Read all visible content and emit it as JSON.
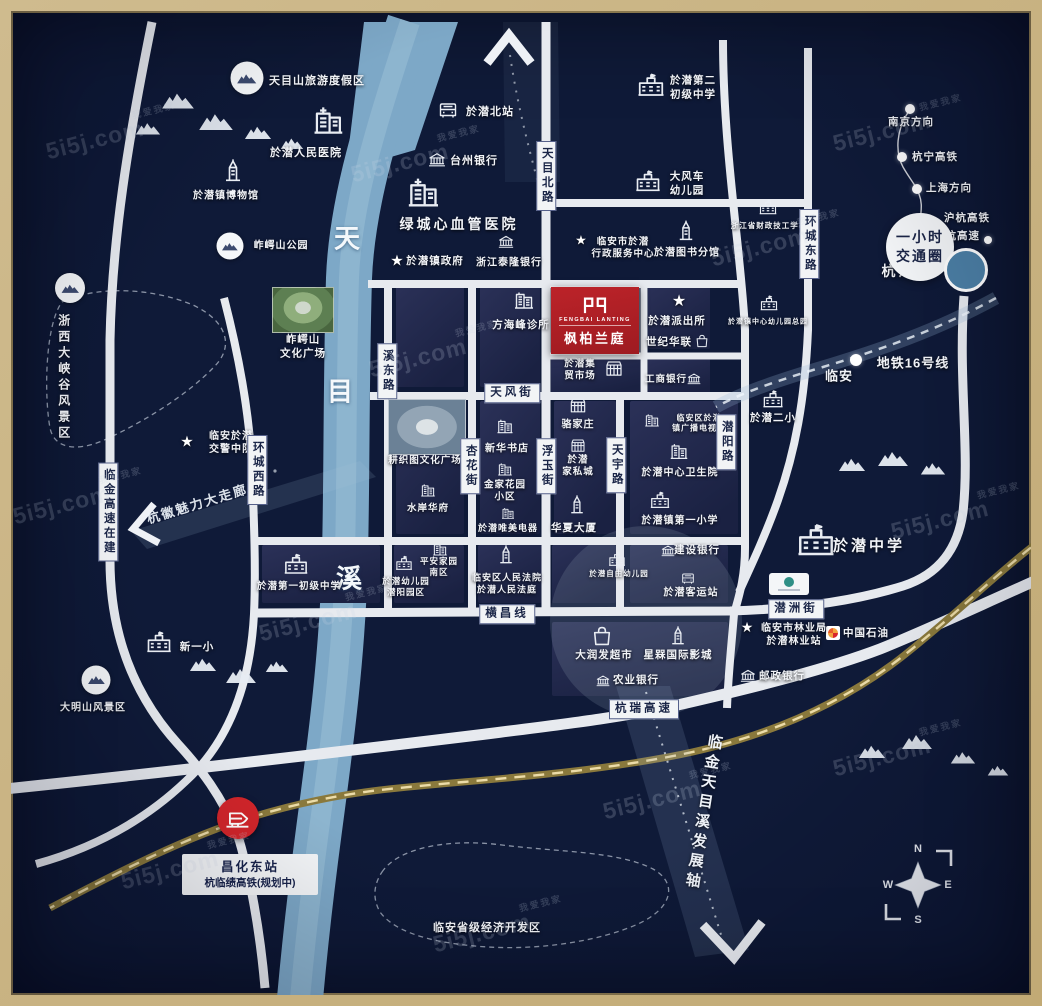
{
  "glyphs": {
    "star": "★"
  },
  "colors": {
    "bg": "#0f1a38",
    "river": "#7da8c7",
    "road": "#e7eaef",
    "gold_frame": "#c2aa75",
    "project_red": "#b02025",
    "railway": "#8a793c",
    "hangzhou_blue": "#4c80a6"
  },
  "project": {
    "name_en": "FENGBAI LANTING",
    "name_cn": "枫柏兰庭"
  },
  "transit": {
    "one_hour_l1": "一小时",
    "one_hour_l2": "交通圈"
  },
  "station": {
    "name": "昌化东站",
    "note": "杭临绩高铁(规划中)"
  },
  "areas": {
    "corridor": "杭徽魅力大走廊",
    "axis": "临金天目溪发展轴",
    "econ_zone": "临安省级经济开发区"
  },
  "compass": {
    "n": "N",
    "e": "E",
    "s": "S",
    "w": "W"
  },
  "watermark": {
    "text": "5i5j.com",
    "tag": "我爱我家",
    "positions": [
      [
        95,
        140
      ],
      [
        400,
        163
      ],
      [
        882,
        132
      ],
      [
        418,
        358
      ],
      [
        62,
        505
      ],
      [
        308,
        622
      ],
      [
        652,
        800
      ],
      [
        882,
        757
      ],
      [
        482,
        933
      ],
      [
        760,
        247
      ],
      [
        170,
        870
      ],
      [
        940,
        520
      ]
    ]
  },
  "river": {
    "chars": [
      {
        "c": "天",
        "x": 347,
        "y": 237
      },
      {
        "c": "目",
        "x": 340,
        "y": 390
      },
      {
        "c": "溪",
        "x": 349,
        "y": 577
      }
    ]
  },
  "road_labels": [
    {
      "text": "天目北路",
      "x": 546,
      "y": 176,
      "vert": true
    },
    {
      "text": "溪东路",
      "x": 387,
      "y": 371,
      "vert": true
    },
    {
      "text": "杏花街",
      "x": 470,
      "y": 466,
      "vert": true
    },
    {
      "text": "浮玉街",
      "x": 546,
      "y": 466,
      "vert": true
    },
    {
      "text": "天宇路",
      "x": 616,
      "y": 465,
      "vert": true
    },
    {
      "text": "潜阳路",
      "x": 726,
      "y": 442,
      "vert": true
    },
    {
      "text": "环城东路",
      "x": 809,
      "y": 244,
      "vert": true
    },
    {
      "text": "环城西路",
      "x": 257,
      "y": 470,
      "vert": true
    },
    {
      "text": "临金高速在建",
      "x": 108,
      "y": 512,
      "vert": true
    },
    {
      "text": "天风街",
      "x": 512,
      "y": 393,
      "vert": false
    },
    {
      "text": "横昌线",
      "x": 507,
      "y": 614,
      "vert": false
    },
    {
      "text": "潜洲街",
      "x": 796,
      "y": 609,
      "vert": false
    },
    {
      "text": "杭瑞高速",
      "x": 644,
      "y": 709,
      "vert": false
    }
  ],
  "pois": [
    {
      "icon": "mtncircle",
      "ix": 247,
      "iy": 78,
      "isz": 33,
      "label": "天目山旅游度假区",
      "lx": 317,
      "ly": 81,
      "fs": 11
    },
    {
      "icon": "hospital",
      "ix": 328,
      "iy": 120,
      "isz": 38,
      "label": "於潜人民医院",
      "lx": 306,
      "ly": 153,
      "fs": 11
    },
    {
      "icon": "museum",
      "ix": 233,
      "iy": 171,
      "isz": 28,
      "label": "於潜镇博物馆",
      "lx": 226,
      "ly": 196,
      "fs": 10
    },
    {
      "icon": "mtncircle",
      "ix": 230,
      "iy": 246,
      "isz": 27,
      "label": "岞崿山公园",
      "lx": 281,
      "ly": 246,
      "fs": 10
    },
    {
      "icon": "mtncircle",
      "ix": 70,
      "iy": 288,
      "isz": 30
    },
    {
      "label": "浙西大峡谷风景区",
      "lx": 63,
      "ly": 378,
      "fs": 12,
      "vert": true
    },
    {
      "icon": "star",
      "ix": 187,
      "iy": 442,
      "isz": 15,
      "label": "临安於潜\n交警中队",
      "lx": 231,
      "ly": 443,
      "fs": 10
    },
    {
      "icon": "mtncircle",
      "ix": 96,
      "iy": 680,
      "isz": 29,
      "label": "大明山风景区",
      "lx": 93,
      "ly": 708,
      "fs": 10
    },
    {
      "icon": "school",
      "ix": 159,
      "iy": 642,
      "isz": 28,
      "label": "新一小",
      "lx": 197,
      "ly": 648,
      "fs": 10.5
    },
    {
      "icon": "bus",
      "ix": 448,
      "iy": 111,
      "isz": 24,
      "label": "於潜北站",
      "lx": 490,
      "ly": 112,
      "fs": 11
    },
    {
      "icon": "bank",
      "ix": 437,
      "iy": 160,
      "isz": 20,
      "label": "台州银行",
      "lx": 474,
      "ly": 161,
      "fs": 11
    },
    {
      "icon": "hospital",
      "ix": 423,
      "iy": 192,
      "isz": 40,
      "label": "绿城心血管医院",
      "lx": 459,
      "ly": 224,
      "fs": 14
    },
    {
      "icon": "star",
      "ix": 397,
      "iy": 261,
      "isz": 15,
      "label": "於潜镇政府",
      "lx": 435,
      "ly": 262,
      "fs": 10.5
    },
    {
      "icon": "bank",
      "ix": 506,
      "iy": 242,
      "isz": 18,
      "label": "浙江泰隆银行",
      "lx": 509,
      "ly": 263,
      "fs": 10
    },
    {
      "icon": "school",
      "ix": 651,
      "iy": 85,
      "isz": 30,
      "label": "於潜第二\n初级中学",
      "lx": 693,
      "ly": 88,
      "fs": 10.5
    },
    {
      "icon": "school",
      "ix": 648,
      "iy": 181,
      "isz": 28,
      "label": "大风车\n幼儿园",
      "lx": 687,
      "ly": 184,
      "fs": 10.5
    },
    {
      "icon": "star",
      "ix": 581,
      "iy": 240,
      "isz": 13,
      "label": "临安市於潜\n行政服务中心",
      "lx": 623,
      "ly": 249,
      "fs": 9.5
    },
    {
      "icon": "museum",
      "ix": 686,
      "iy": 231,
      "isz": 25,
      "label": "於潜图书分馆",
      "lx": 687,
      "ly": 253,
      "fs": 10
    },
    {
      "icon": "school",
      "ix": 768,
      "iy": 207,
      "isz": 20,
      "label": "浙江省财政技工学校",
      "lx": 769,
      "ly": 226,
      "fs": 7.5
    },
    {
      "icon": "school",
      "ix": 769,
      "iy": 303,
      "isz": 20,
      "label": "於潜镇中心幼儿园总园",
      "lx": 768,
      "ly": 322,
      "fs": 7
    },
    {
      "label": "南京方向",
      "lx": 911,
      "ly": 123,
      "fs": 10.5
    },
    {
      "label": "杭宁高铁",
      "lx": 935,
      "ly": 158,
      "fs": 10.5
    },
    {
      "label": "上海方向",
      "lx": 949,
      "ly": 189,
      "fs": 10.5
    },
    {
      "label": "沪杭高铁",
      "lx": 967,
      "ly": 219,
      "fs": 10.5
    },
    {
      "label": "沪杭高速",
      "lx": 957,
      "ly": 237,
      "fs": 10.5
    },
    {
      "label": "杭州市",
      "lx": 907,
      "ly": 271,
      "fs": 14
    },
    {
      "label": "地铁16号线",
      "lx": 913,
      "ly": 364,
      "fs": 13
    },
    {
      "label": "临安",
      "lx": 839,
      "ly": 377,
      "fs": 13
    },
    {
      "icon": "star",
      "ix": 747,
      "iy": 627,
      "isz": 14,
      "label": "临安市林业局\n於潜林业站",
      "lx": 794,
      "ly": 635,
      "fs": 10
    },
    {
      "icon": "gas",
      "ix": 833,
      "iy": 633,
      "isz": 14,
      "label": "中国石油",
      "lx": 866,
      "ly": 634,
      "fs": 10.5
    },
    {
      "icon": "bank",
      "ix": 748,
      "iy": 676,
      "isz": 18,
      "label": "邮政银行",
      "lx": 782,
      "ly": 677,
      "fs": 10.5
    },
    {
      "icon": "school",
      "ix": 816,
      "iy": 540,
      "isz": 42,
      "label": "於潜中学",
      "lx": 869,
      "ly": 546,
      "fs": 15
    },
    {
      "icon": "building",
      "ix": 524,
      "iy": 300,
      "isz": 24,
      "label": "方海峰诊所",
      "lx": 521,
      "ly": 326,
      "fs": 10.5
    },
    {
      "label": "岞崿山\n文化广场",
      "lx": 303,
      "ly": 347,
      "fs": 10.5
    },
    {
      "label": "耕织图文化广场",
      "lx": 425,
      "ly": 461,
      "fs": 9.5
    },
    {
      "icon": "building",
      "ix": 505,
      "iy": 426,
      "isz": 20,
      "label": "新华书店",
      "lx": 507,
      "ly": 449,
      "fs": 10
    },
    {
      "icon": "building",
      "ix": 505,
      "iy": 469,
      "isz": 18,
      "label": "金家花园\n小区",
      "lx": 505,
      "ly": 492,
      "fs": 9.5
    },
    {
      "icon": "building",
      "ix": 428,
      "iy": 490,
      "isz": 18,
      "label": "水岸华府",
      "lx": 428,
      "ly": 509,
      "fs": 9.5
    },
    {
      "icon": "building",
      "ix": 508,
      "iy": 513,
      "isz": 16,
      "label": "於潜唯美电器",
      "lx": 508,
      "ly": 529,
      "fs": 9
    },
    {
      "icon": "market",
      "ix": 578,
      "iy": 406,
      "isz": 20,
      "label": "骆家庄",
      "lx": 578,
      "ly": 425,
      "fs": 10
    },
    {
      "icon": "market",
      "ix": 578,
      "iy": 446,
      "isz": 18,
      "label": "於潜\n家私城",
      "lx": 578,
      "ly": 467,
      "fs": 9.5
    },
    {
      "icon": "museum",
      "ix": 577,
      "iy": 505,
      "isz": 23,
      "label": "华夏大厦",
      "lx": 574,
      "ly": 529,
      "fs": 10.5
    },
    {
      "icon": "building",
      "ix": 652,
      "iy": 420,
      "isz": 18,
      "label": "临安区於潜\n镇广播电视台",
      "lx": 699,
      "ly": 424,
      "fs": 8
    },
    {
      "icon": "building",
      "ix": 679,
      "iy": 451,
      "isz": 22,
      "label": "於潜中心卫生院",
      "lx": 680,
      "ly": 473,
      "fs": 10
    },
    {
      "icon": "school",
      "ix": 660,
      "iy": 500,
      "isz": 22,
      "label": "於潜镇第一小学",
      "lx": 680,
      "ly": 521,
      "fs": 10
    },
    {
      "icon": "school",
      "ix": 773,
      "iy": 399,
      "isz": 23,
      "label": "於潜二小",
      "lx": 773,
      "ly": 419,
      "fs": 10.5
    },
    {
      "icon": "star",
      "ix": 679,
      "iy": 302,
      "isz": 16,
      "label": "於潜派出所",
      "lx": 677,
      "ly": 322,
      "fs": 10.5
    },
    {
      "label": "世纪华联",
      "lx": 669,
      "ly": 343,
      "fs": 10.5
    },
    {
      "icon": "mall",
      "ix": 702,
      "iy": 341,
      "isz": 18
    },
    {
      "label": "於潜集\n贸市场",
      "lx": 580,
      "ly": 371,
      "fs": 9.5
    },
    {
      "icon": "market",
      "ix": 614,
      "iy": 369,
      "isz": 21
    },
    {
      "label": "工商银行",
      "lx": 666,
      "ly": 380,
      "fs": 9.5
    },
    {
      "icon": "bank",
      "ix": 694,
      "iy": 379,
      "isz": 16
    },
    {
      "icon": "school",
      "ix": 296,
      "iy": 564,
      "isz": 27,
      "label": "於潜第一初级中学",
      "lx": 299,
      "ly": 587,
      "fs": 9.5
    },
    {
      "icon": "school",
      "ix": 404,
      "iy": 563,
      "isz": 19,
      "label": "於潜幼儿园\n潜阳园区",
      "lx": 406,
      "ly": 587,
      "fs": 8.5
    },
    {
      "icon": "building",
      "ix": 440,
      "iy": 549,
      "isz": 18,
      "label": "平安家园\n南区",
      "lx": 439,
      "ly": 567,
      "fs": 8.5
    },
    {
      "icon": "museum",
      "ix": 506,
      "iy": 555,
      "isz": 23,
      "label": "临安区人民法院\n於潜人民法庭",
      "lx": 507,
      "ly": 584,
      "fs": 9
    },
    {
      "icon": "school",
      "ix": 617,
      "iy": 559,
      "isz": 19,
      "label": "於潜自由幼儿园",
      "lx": 619,
      "ly": 574,
      "fs": 7.5
    },
    {
      "icon": "bank",
      "ix": 668,
      "iy": 551,
      "isz": 16,
      "label": "建设银行",
      "lx": 697,
      "ly": 551,
      "fs": 10.5
    },
    {
      "icon": "bus",
      "ix": 688,
      "iy": 579,
      "isz": 17,
      "label": "於潜客运站",
      "lx": 691,
      "ly": 593,
      "fs": 10
    },
    {
      "icon": "mall",
      "ix": 602,
      "iy": 636,
      "isz": 27,
      "label": "大润发超市",
      "lx": 604,
      "ly": 656,
      "fs": 10.5
    },
    {
      "icon": "museum",
      "ix": 678,
      "iy": 636,
      "isz": 23,
      "label": "星槑国际影城",
      "lx": 678,
      "ly": 656,
      "fs": 10.5
    },
    {
      "icon": "bank",
      "ix": 603,
      "iy": 681,
      "isz": 16,
      "label": "农业银行",
      "lx": 636,
      "ly": 681,
      "fs": 10.5
    },
    {
      "label": "临安省级经济开发区",
      "lx": 487,
      "ly": 928,
      "fs": 11
    }
  ],
  "dots": [
    [
      910,
      109,
      10
    ],
    [
      902,
      157,
      10
    ],
    [
      917,
      189,
      10
    ],
    [
      921,
      225,
      8
    ],
    [
      988,
      240,
      8
    ],
    [
      932,
      255,
      8
    ],
    [
      856,
      360,
      12
    ]
  ],
  "panels": [
    [
      396,
      283,
      68,
      104
    ],
    [
      480,
      283,
      60,
      104
    ],
    [
      551,
      358,
      89,
      36
    ],
    [
      648,
      283,
      62,
      66
    ],
    [
      648,
      358,
      62,
      38
    ],
    [
      396,
      401,
      68,
      133
    ],
    [
      480,
      401,
      60,
      133
    ],
    [
      554,
      401,
      62,
      133
    ],
    [
      630,
      401,
      108,
      133
    ],
    [
      262,
      545,
      118,
      58
    ],
    [
      394,
      545,
      70,
      58
    ],
    [
      478,
      545,
      64,
      58
    ],
    [
      552,
      545,
      64,
      58
    ],
    [
      630,
      545,
      98,
      58
    ],
    [
      552,
      622,
      176,
      74
    ]
  ],
  "mountains": [
    [
      178,
      100,
      34
    ],
    [
      148,
      128,
      26
    ],
    [
      216,
      121,
      36
    ],
    [
      258,
      132,
      28
    ],
    [
      292,
      143,
      24
    ],
    [
      203,
      664,
      28
    ],
    [
      241,
      675,
      32
    ],
    [
      277,
      666,
      24
    ],
    [
      852,
      464,
      28
    ],
    [
      893,
      458,
      32
    ],
    [
      933,
      468,
      26
    ],
    [
      872,
      751,
      28
    ],
    [
      917,
      741,
      32
    ],
    [
      963,
      757,
      26
    ],
    [
      998,
      770,
      22
    ]
  ]
}
